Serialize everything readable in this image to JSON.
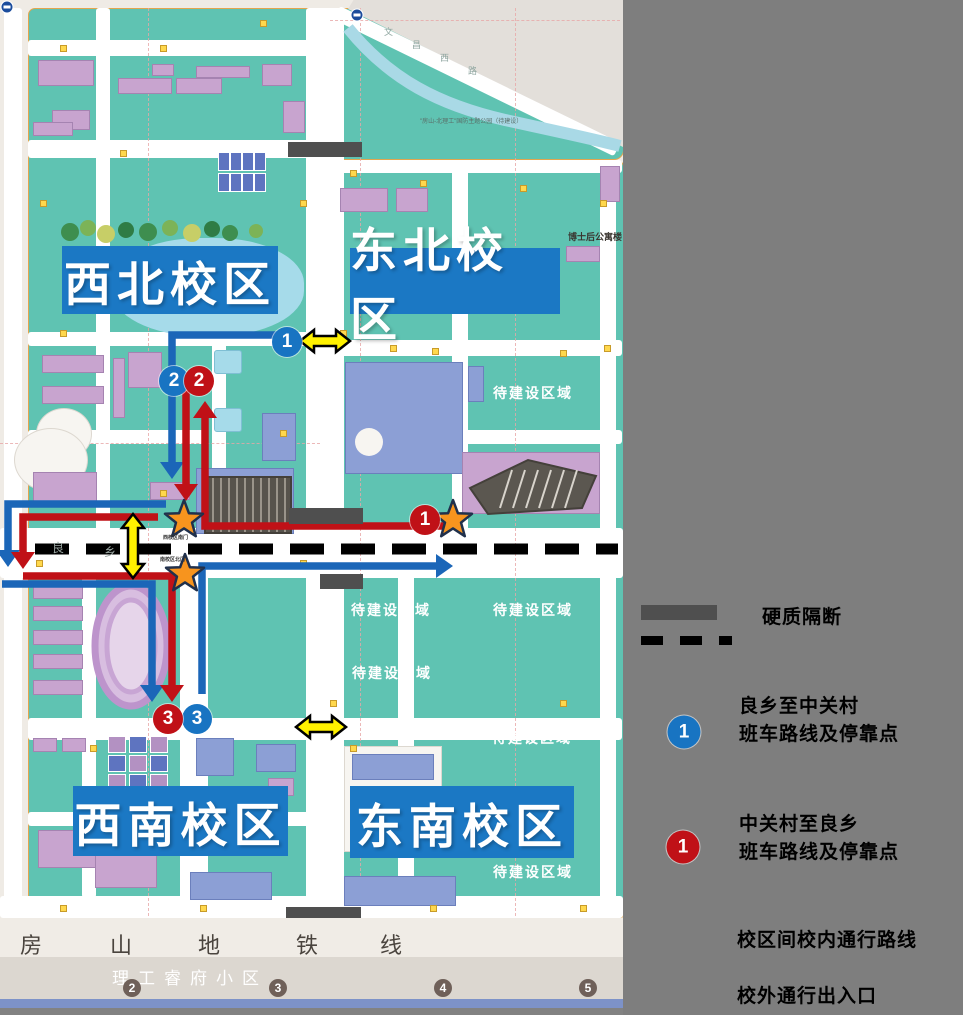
{
  "colors": {
    "teal": "#5FC3B2",
    "panel": "#7E7E7E",
    "route_blue": "#1B66B8",
    "route_red": "#C01117",
    "circle_blue": "#1874C2",
    "circle_red": "#C01117",
    "campus_label_blue": "#1B78C4",
    "yellow": "#FFF100",
    "star_orange": "#F7941E",
    "partition_gray": "#4F4F4F",
    "subway_bar_blue": "#7D92C8",
    "lake": "#A6DBEA"
  },
  "legend": {
    "partition_label": "硬质隔断",
    "blue_badge": "1",
    "blue_line1": "良乡至中关村",
    "blue_line2": "班车路线及停靠点",
    "red_badge": "1",
    "red_line1": "中关村至良乡",
    "red_line2": "班车路线及停靠点",
    "transfer_label": "校区间校内通行路线",
    "gate_label": "校外通行出入口"
  },
  "campuses": [
    {
      "name": "西北校区",
      "x": 62,
      "y": 246,
      "w": 216,
      "h": 68
    },
    {
      "name": "东北校区",
      "x": 350,
      "y": 248,
      "w": 210,
      "h": 66
    },
    {
      "name": "西南校区",
      "x": 73,
      "y": 786,
      "w": 215,
      "h": 70
    },
    {
      "name": "东南校区",
      "x": 350,
      "y": 786,
      "w": 224,
      "h": 72
    }
  ],
  "pending_labels": [
    {
      "text": "待建设区域",
      "x": 533,
      "y": 393
    },
    {
      "text": "待建设区域",
      "x": 391,
      "y": 610
    },
    {
      "text": "待建设区域",
      "x": 533,
      "y": 610
    },
    {
      "text": "待建设区域",
      "x": 392,
      "y": 673
    },
    {
      "text": "待建设区域",
      "x": 532,
      "y": 738
    },
    {
      "text": "待建设区域",
      "x": 533,
      "y": 872
    }
  ],
  "poi_labels": [
    {
      "text": "博士后公寓楼",
      "x": 568,
      "y": 230,
      "size": 9,
      "color": "#3A3530",
      "bold": true
    },
    {
      "text": "\"房山-北理工\"国防主题公园（待建设）",
      "x": 420,
      "y": 116,
      "size": 6,
      "color": "#5A6E68",
      "bold": false
    }
  ],
  "road_names": {
    "wenchang_chars": [
      {
        "ch": "文",
        "x": 384,
        "y": 25
      },
      {
        "ch": "昌",
        "x": 412,
        "y": 38
      },
      {
        "ch": "西",
        "x": 440,
        "y": 51
      },
      {
        "ch": "路",
        "x": 468,
        "y": 64
      }
    ],
    "liangxiang_chars": [
      {
        "ch": "良",
        "x": 52,
        "y": 539
      },
      {
        "ch": "乡",
        "x": 104,
        "y": 543
      }
    ],
    "mingyuan_chars": [
      {
        "ch": "明",
        "x": 224,
        "y": 927
      },
      {
        "ch": "园",
        "x": 241,
        "y": 927
      },
      {
        "ch": "西",
        "x": 274,
        "y": 927
      },
      {
        "ch": "路",
        "x": 292,
        "y": 927
      }
    ]
  },
  "gates": [
    {
      "label": "西校区南门",
      "x": 163,
      "y": 534
    },
    {
      "label": "南校区北门",
      "x": 160,
      "y": 556
    }
  ],
  "subway": {
    "line_chars": [
      {
        "ch": "房",
        "x": 20
      },
      {
        "ch": "山",
        "x": 110
      },
      {
        "ch": "地",
        "x": 198
      },
      {
        "ch": "铁",
        "x": 296
      },
      {
        "ch": "线",
        "x": 380
      }
    ],
    "community": "理工睿府小区",
    "stations": [
      {
        "n": "2",
        "x": 132
      },
      {
        "n": "3",
        "x": 278
      },
      {
        "n": "4",
        "x": 443
      },
      {
        "n": "5",
        "x": 588
      }
    ]
  },
  "stops": {
    "blue": [
      {
        "n": "1",
        "x": 287,
        "y": 342
      },
      {
        "n": "2",
        "x": 174,
        "y": 381
      },
      {
        "n": "3",
        "x": 197,
        "y": 719
      }
    ],
    "red": [
      {
        "n": "1",
        "x": 425,
        "y": 520
      },
      {
        "n": "2",
        "x": 199,
        "y": 381
      },
      {
        "n": "3",
        "x": 168,
        "y": 719
      }
    ]
  },
  "routes": {
    "blue": [
      {
        "points": [
          [
            285,
            335
          ],
          [
            172,
            335
          ],
          [
            172,
            462
          ]
        ],
        "head": "down"
      },
      {
        "points": [
          [
            166,
            504
          ],
          [
            8,
            504
          ],
          [
            8,
            550
          ]
        ],
        "head": "down"
      },
      {
        "points": [
          [
            2,
            584
          ],
          [
            152,
            584
          ],
          [
            152,
            685
          ]
        ],
        "head": "down"
      },
      {
        "points": [
          [
            202,
            694
          ],
          [
            202,
            566
          ],
          [
            436,
            566
          ]
        ],
        "head": "right"
      }
    ],
    "red": [
      {
        "points": [
          [
            450,
            526
          ],
          [
            205,
            526
          ],
          [
            205,
            418
          ]
        ],
        "head": "up"
      },
      {
        "points": [
          [
            158,
            517
          ],
          [
            23,
            517
          ],
          [
            23,
            552
          ]
        ],
        "head": "down"
      },
      {
        "points": [
          [
            186,
            390
          ],
          [
            186,
            484
          ]
        ],
        "head": "down"
      },
      {
        "points": [
          [
            23,
            576
          ],
          [
            172,
            576
          ],
          [
            172,
            685
          ]
        ],
        "head": "down"
      }
    ]
  },
  "yellow_arrows": [
    {
      "cx": 325,
      "cy": 341,
      "dir": "h",
      "len": 50
    },
    {
      "cx": 133,
      "cy": 546,
      "dir": "v",
      "len": 64
    },
    {
      "cx": 321,
      "cy": 727,
      "dir": "h",
      "len": 50
    },
    {
      "cx": 683,
      "cy": 935,
      "dir": "h",
      "len": 52
    }
  ],
  "stars": [
    {
      "x": 184,
      "y": 520,
      "r": 20
    },
    {
      "x": 185,
      "y": 574,
      "r": 20
    },
    {
      "x": 453,
      "y": 520,
      "r": 20
    },
    {
      "x": 681,
      "y": 991,
      "r": 22
    }
  ],
  "partitions": [
    {
      "x": 288,
      "y": 142,
      "w": 74,
      "h": 15
    },
    {
      "x": 289,
      "y": 508,
      "w": 74,
      "h": 16
    },
    {
      "x": 320,
      "y": 574,
      "w": 43,
      "h": 15
    },
    {
      "x": 286,
      "y": 907,
      "w": 75,
      "h": 14
    }
  ],
  "dashed_partition": {
    "x1": 35,
    "x2": 618,
    "y": 549
  }
}
